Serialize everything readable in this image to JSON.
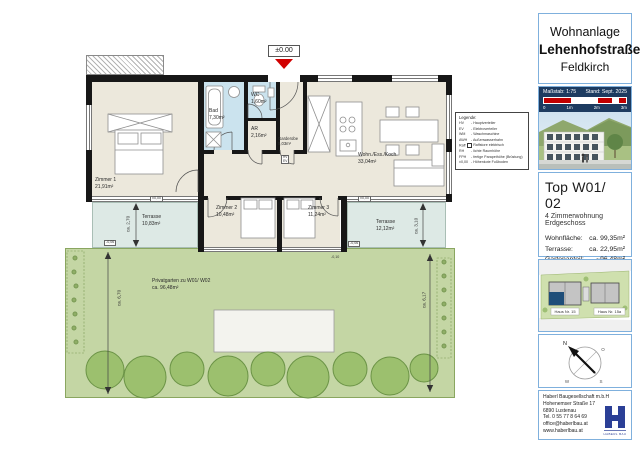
{
  "colors": {
    "accent_blue": "#1F4E79",
    "scale_red": "#C00000",
    "garden_green": "#C4D6A4",
    "terrace_teal": "#DDE9E5",
    "wet_room_blue": "#CBE3EE",
    "room_beige": "#ECE8DC",
    "logo_blue": "#2B3F96",
    "panel_border": "#7FB0DD"
  },
  "sidebar": {
    "title": {
      "line1": "Wohnanlage",
      "line2": "Lehenhofstraße",
      "line3": "Feldkirch"
    },
    "scale": {
      "massstab": "Maßstab: 1:75",
      "stand": "Stand: Sept. 2025",
      "ticks": [
        "0",
        "1m",
        "2m",
        "3m"
      ]
    },
    "unit": {
      "title": "Top W01/ 02",
      "sub1": "4 Zimmerwohnung",
      "sub2": "Erdgeschoss",
      "rows": [
        {
          "label": "Wohnfläche:",
          "value": "ca. 99,35m²"
        },
        {
          "label": "Terrasse:",
          "value": "ca. 22,95m²"
        },
        {
          "label": "Gartenanteil:",
          "value": "~96,48m²"
        }
      ]
    },
    "siteplan": {
      "house_left": "Haus Nr. 15",
      "house_right": "Haus Nr. 15a"
    },
    "compass": {
      "n": "N",
      "o": "O",
      "s": "S",
      "w": "W"
    },
    "company": {
      "name": "Haberl Baugesellschaft m.b.H",
      "street": "Hohenemser Straße 17",
      "city": "6890 Lustenau",
      "tel": "Tel. 0 55 77 8 64 69",
      "email": "office@haberlbau.at",
      "web": "www.haberlbau.at",
      "logo_text": "HABERL BAU"
    }
  },
  "plan": {
    "level_marker": "±0.00",
    "rooms": [
      {
        "name": "Zimmer 1",
        "area": "21,91m²"
      },
      {
        "name": "Bad",
        "area": "7,30m²"
      },
      {
        "name": "WC",
        "area": "1,60m²"
      },
      {
        "name": "AR",
        "area": "2,16m²"
      },
      {
        "name": "Garderobe",
        "area": "5,03m²"
      },
      {
        "name": "Wohn./Ess./Koch.",
        "area": "33,04m²"
      },
      {
        "name": "Zimmer 2",
        "area": "10,48m²"
      },
      {
        "name": "Zimmer 3",
        "area": "11,24m²"
      },
      {
        "name": "Terrasse",
        "area": "10,83m²"
      },
      {
        "name": "Terrasse",
        "area": "12,12m²"
      }
    ],
    "garden_label": {
      "line1": "Privatgarten zu W01/ W02",
      "line2": "ca. 96,48m²"
    },
    "equip": {
      "line1": "HV",
      "line2": "EV"
    },
    "kotes": [
      "±0,00",
      "-0,06",
      "±0,00",
      "-0,06",
      "-0,10"
    ],
    "dims": {
      "terrace_left": "ca. 2,70",
      "terrace_right": "ca. 3,10",
      "garden_left": "ca. 6,70",
      "garden_right": "ca. 6,17"
    },
    "legend": {
      "title": "Legende:",
      "rows": [
        {
          "abbr": "HV",
          "desc": "- Hauptverteiler"
        },
        {
          "abbr": "EV",
          "desc": "- Elektroverteiler"
        },
        {
          "abbr": "WM",
          "desc": "- Waschmaschine"
        },
        {
          "abbr": "AWH",
          "desc": "- Außenwasserhahn"
        },
        {
          "abbr": "Raff",
          "desc": "- Raffstore elektrisch"
        },
        {
          "abbr": "RH",
          "desc": "- lichte Raumhöhe"
        },
        {
          "abbr": "FPH",
          "desc": "- fertige Parapethöhe (Brüstung)"
        },
        {
          "abbr": "±0,00",
          "desc": "- Höhenkote Fußboden"
        }
      ]
    }
  }
}
